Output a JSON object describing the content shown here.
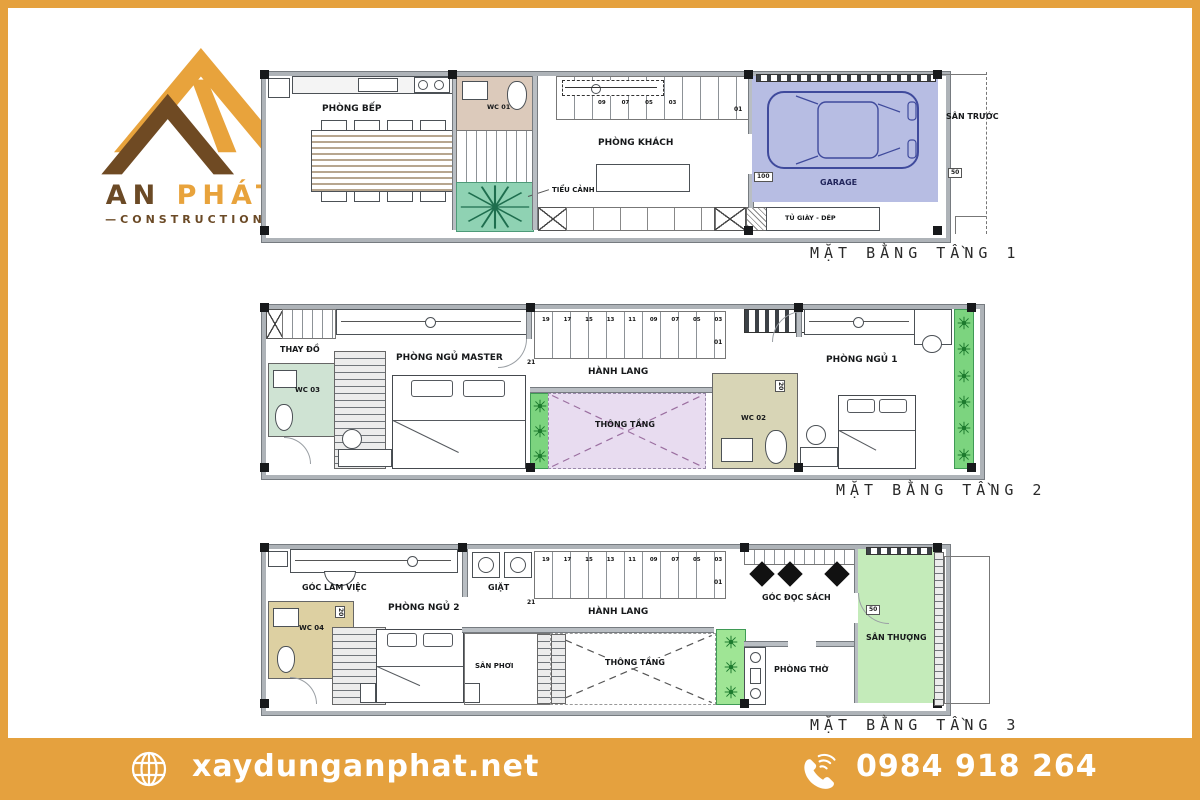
{
  "logo": {
    "name_left": "AN",
    "name_right": "PHÁT",
    "tagline": "CONSTRUCTION"
  },
  "floor1": {
    "caption": "MẶT BẰNG TẦNG 1",
    "kitchen": "PHÒNG BẾP",
    "wc": "WC 01",
    "garden": "TIỂU CẢNH",
    "living": "PHÒNG KHÁCH",
    "garage": "GARAGE",
    "shoe_cabinet": "TỦ GIÀY - DÉP",
    "front_yard": "SÂN TRƯỚC",
    "dim_100": "100",
    "dim_50": "50",
    "stair_numbers": "09 07 05 03",
    "stair_end": "01"
  },
  "floor2": {
    "caption": "MẶT BẰNG TẦNG 2",
    "dressing": "THAY ĐỒ",
    "wc3": "WC 03",
    "master": "PHÒNG NGỦ MASTER",
    "hallway": "HÀNH LANG",
    "void": "THÔNG TẦNG",
    "wc2": "WC 02",
    "bedroom1": "PHÒNG NGỦ 1",
    "stair_numbers": "19 17 15 13 11 09 07 05 03",
    "stair_start": "21",
    "stair_end": "01",
    "dim_20": "20"
  },
  "floor3": {
    "caption": "MẶT BẰNG TẦNG 3",
    "work_corner": "GÓC LÀM VIỆC",
    "wc4": "WC 04",
    "bedroom2": "PHÒNG NGỦ 2",
    "laundry": "GIẶT",
    "hallway": "HÀNH LANG",
    "drying_yard": "SÂN PHƠI",
    "void": "THÔNG TẦNG",
    "reading_corner": "GÓC ĐỌC SÁCH",
    "worship": "PHÒNG THỜ",
    "terrace": "SÂN THƯỢNG",
    "stair_numbers": "19 17 15 13 11 09 07 05 03",
    "stair_start": "21",
    "stair_end": "01",
    "dim_50": "50",
    "dim_20": "20"
  },
  "footer": {
    "website": "xaydunganphat.net",
    "phone": "0984 918 264"
  },
  "colors": {
    "accent": "#E5A13E",
    "garage": "#b7bde3",
    "garden": "#8fd2b3",
    "void_purple": "#e8dcf0",
    "terrace": "#c4ebba",
    "plant_strip": "#7cd47f",
    "wc1": "#dccabb",
    "wc3": "#cfe3d3",
    "wc2": "#d8d5b6",
    "wc4": "#ddd0a2"
  }
}
